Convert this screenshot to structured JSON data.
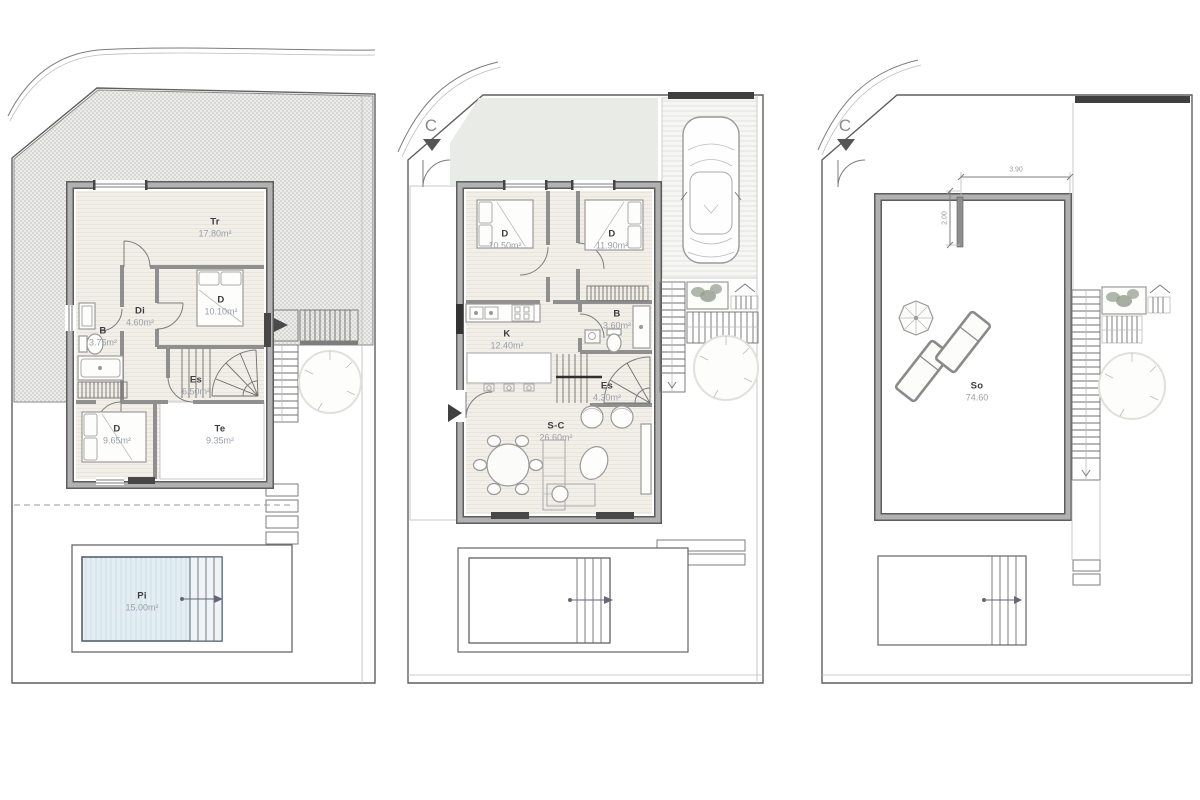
{
  "document": {
    "type": "architectural floor plans",
    "sheets": [
      "first-floor",
      "ground-floor",
      "roof-solarium"
    ]
  },
  "colors": {
    "wall": "#8f8f8f",
    "room_floor": "#f2efe9",
    "roof_hatch": "#d7d7d6",
    "terrace": "#e9e9e7",
    "front_garden": "#e8ebe6",
    "pool_water": "#e3edf4",
    "dark_fixture": "#3f3f3f",
    "label_code": "#3c3c40",
    "label_area": "#99a0aa"
  },
  "plans": [
    {
      "label": "first-floor",
      "rooms": [
        {
          "code": "Tr",
          "area": "17.80m²"
        },
        {
          "code": "D",
          "area": "10.10m²"
        },
        {
          "code": "Di",
          "area": "4.60m²"
        },
        {
          "code": "B",
          "area": "3.75m²"
        },
        {
          "code": "Es",
          "area": "6.50m²"
        },
        {
          "code": "D",
          "area": "9.65m²"
        },
        {
          "code": "Te",
          "area": "9.35m²"
        },
        {
          "code": "Pi",
          "area": "15.00m²"
        }
      ]
    },
    {
      "label": "ground-floor",
      "entrance_marker": "C",
      "rooms": [
        {
          "code": "D",
          "area": "10.50m²"
        },
        {
          "code": "D",
          "area": "11.90m²"
        },
        {
          "code": "K",
          "area": "12.40m²"
        },
        {
          "code": "B",
          "area": "3.60m²"
        },
        {
          "code": "Es",
          "area": "4.30m²"
        },
        {
          "code": "S-C",
          "area": "26.60m²"
        }
      ]
    },
    {
      "label": "roof-solarium",
      "entrance_marker": "C",
      "rooms": [
        {
          "code": "So",
          "area": "74.60"
        }
      ],
      "dimensions": {
        "width": "3.90",
        "depth": "2.00"
      }
    }
  ]
}
